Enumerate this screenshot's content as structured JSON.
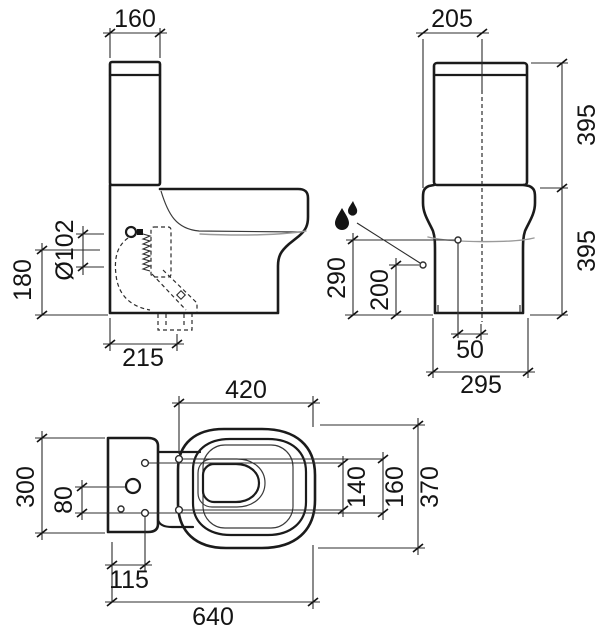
{
  "drawing_type": "toilet-technical-drawing",
  "colors": {
    "line": "#1b1b1b",
    "secondary_line": "#9a9a9a",
    "background": "#ffffff"
  },
  "icons": {
    "water_supply": "water-drops-icon"
  },
  "views": {
    "side": {
      "tank_width": "160",
      "inlet_diameter": "Ø102",
      "inlet_height": "180",
      "trap_distance": "215"
    },
    "front": {
      "center_to_side": "205",
      "tank_height": "395",
      "bowl_height": "395",
      "rim_height": "290",
      "supply_height": "200",
      "supply_offset": "50",
      "base_width": "295"
    },
    "plan": {
      "seat_length": "420",
      "tank_depth": "300",
      "inlet_spacing": "80",
      "hinge_hole_span": "140",
      "fixing_hole_span": "160",
      "bowl_width": "370",
      "fixing_hole_offset": "115",
      "overall_length": "640"
    }
  }
}
